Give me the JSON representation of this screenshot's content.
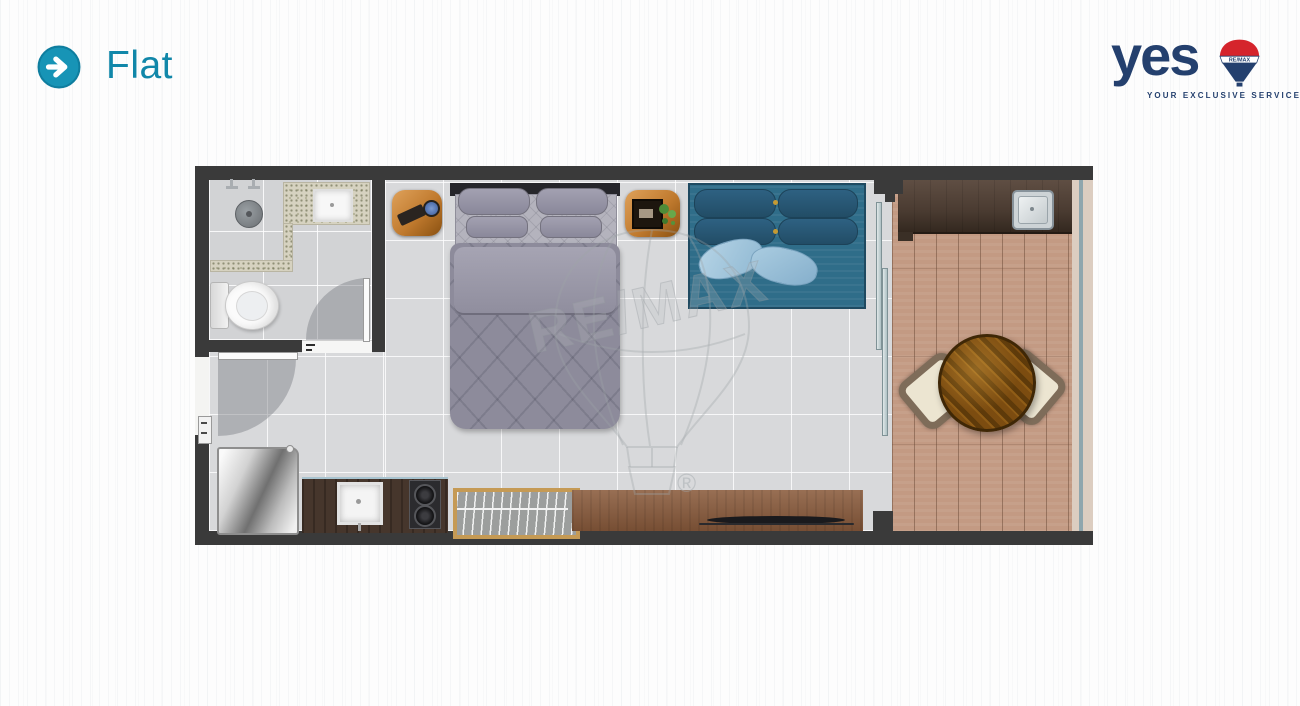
{
  "header": {
    "title": "Flat"
  },
  "brand": {
    "word": "yes",
    "tagline": "YOUR EXCLUSIVE SERVICES",
    "balloon_label": "RE/MAX"
  },
  "watermark": {
    "text": "RE/MAX",
    "registered": "®"
  },
  "palette": {
    "accent_teal": "#1794b6",
    "brand_navy": "#24406e",
    "brand_red": "#d5242c",
    "wall_dark": "#3a3a3a",
    "tile_gray": "#d8d9db",
    "balcony_wood": "#c39a83",
    "sofa_blue": "#2f6d89",
    "bed_gray": "#8d8b9b",
    "sideboard_brown": "#8a5b3c",
    "counter_darkwood": "#46362c",
    "table_wood": "#7a4a10"
  },
  "floorplan": {
    "rooms": [
      "bathroom",
      "bedroom-living",
      "kitchen",
      "balcony"
    ],
    "furniture": [
      "shower-head",
      "shower-controls",
      "vanity-sink",
      "toilet",
      "bathroom-door",
      "entry-door",
      "double-bed",
      "nightstand-left",
      "nightstand-right",
      "sofa",
      "sliding-glass-door",
      "fridge",
      "kitchen-sink",
      "cooktop",
      "dish-rack",
      "sideboard",
      "tv",
      "balcony-counter",
      "balcony-sink",
      "round-table",
      "chair-left",
      "chair-right",
      "glass-railing"
    ]
  }
}
